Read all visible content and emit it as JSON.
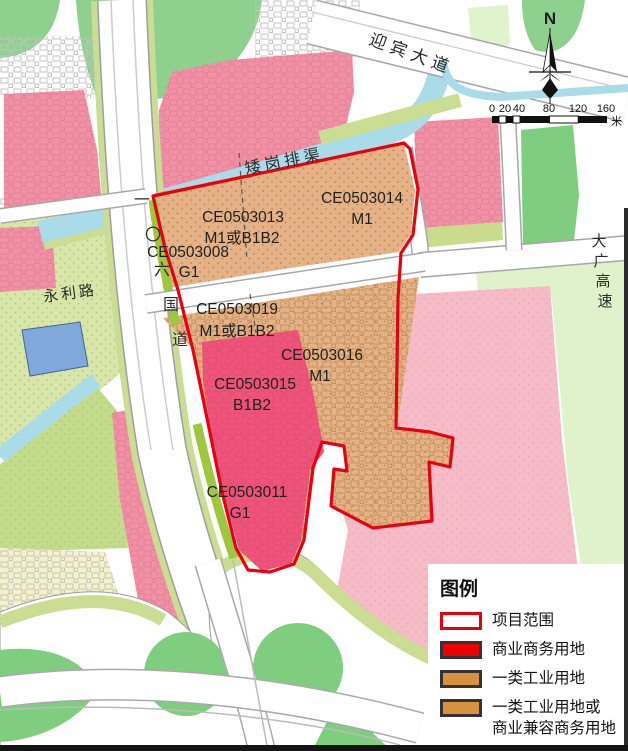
{
  "map": {
    "north_label": "N",
    "roads": {
      "yingbin": "迎宾大道",
      "canal": "矮岗排渠",
      "yongli": "永利路",
      "g106": [
        "一",
        "〇",
        "六",
        "国",
        "道"
      ],
      "daguang": [
        "大",
        "广",
        "高",
        "速"
      ]
    },
    "parcels": [
      {
        "code": "CE0503013",
        "use": "M1或B1B2"
      },
      {
        "code": "CE0503014",
        "use": "M1"
      },
      {
        "code": "CE0503008",
        "use": "G1"
      },
      {
        "code": "CE0503019",
        "use": "M1或B1B2"
      },
      {
        "code": "CE0503016",
        "use": "M1"
      },
      {
        "code": "CE0503015",
        "use": "B1B2"
      },
      {
        "code": "CE0503011",
        "use": "G1"
      }
    ],
    "scale": {
      "ticks": [
        "0",
        "20",
        "40",
        "80",
        "120",
        "160"
      ],
      "unit": "米"
    }
  },
  "legend": {
    "title": "图例",
    "items": [
      {
        "label": "项目范围",
        "fill": "#ffffff",
        "border": "#e60012"
      },
      {
        "label": "商业商务用地",
        "fill": "#ee0000",
        "border": "#333333"
      },
      {
        "label": "一类工业用地",
        "fill": "#d9913f",
        "border": "#333333"
      },
      {
        "label": "一类工业用地或",
        "label2": "商业兼容商务用地",
        "fill": "#d9913f",
        "border": "#333333"
      },
      {
        "label": "公园绿地",
        "fill": "#56b01c",
        "border": "#333333"
      }
    ]
  },
  "colors": {
    "project_boundary": "#e60012",
    "industrial_parcel": "#e4b286",
    "commercial_parcel": "#f1547b",
    "residential_pink": "#f291a4",
    "park_green": "#7fce7f",
    "water": "#a8dbe8"
  }
}
